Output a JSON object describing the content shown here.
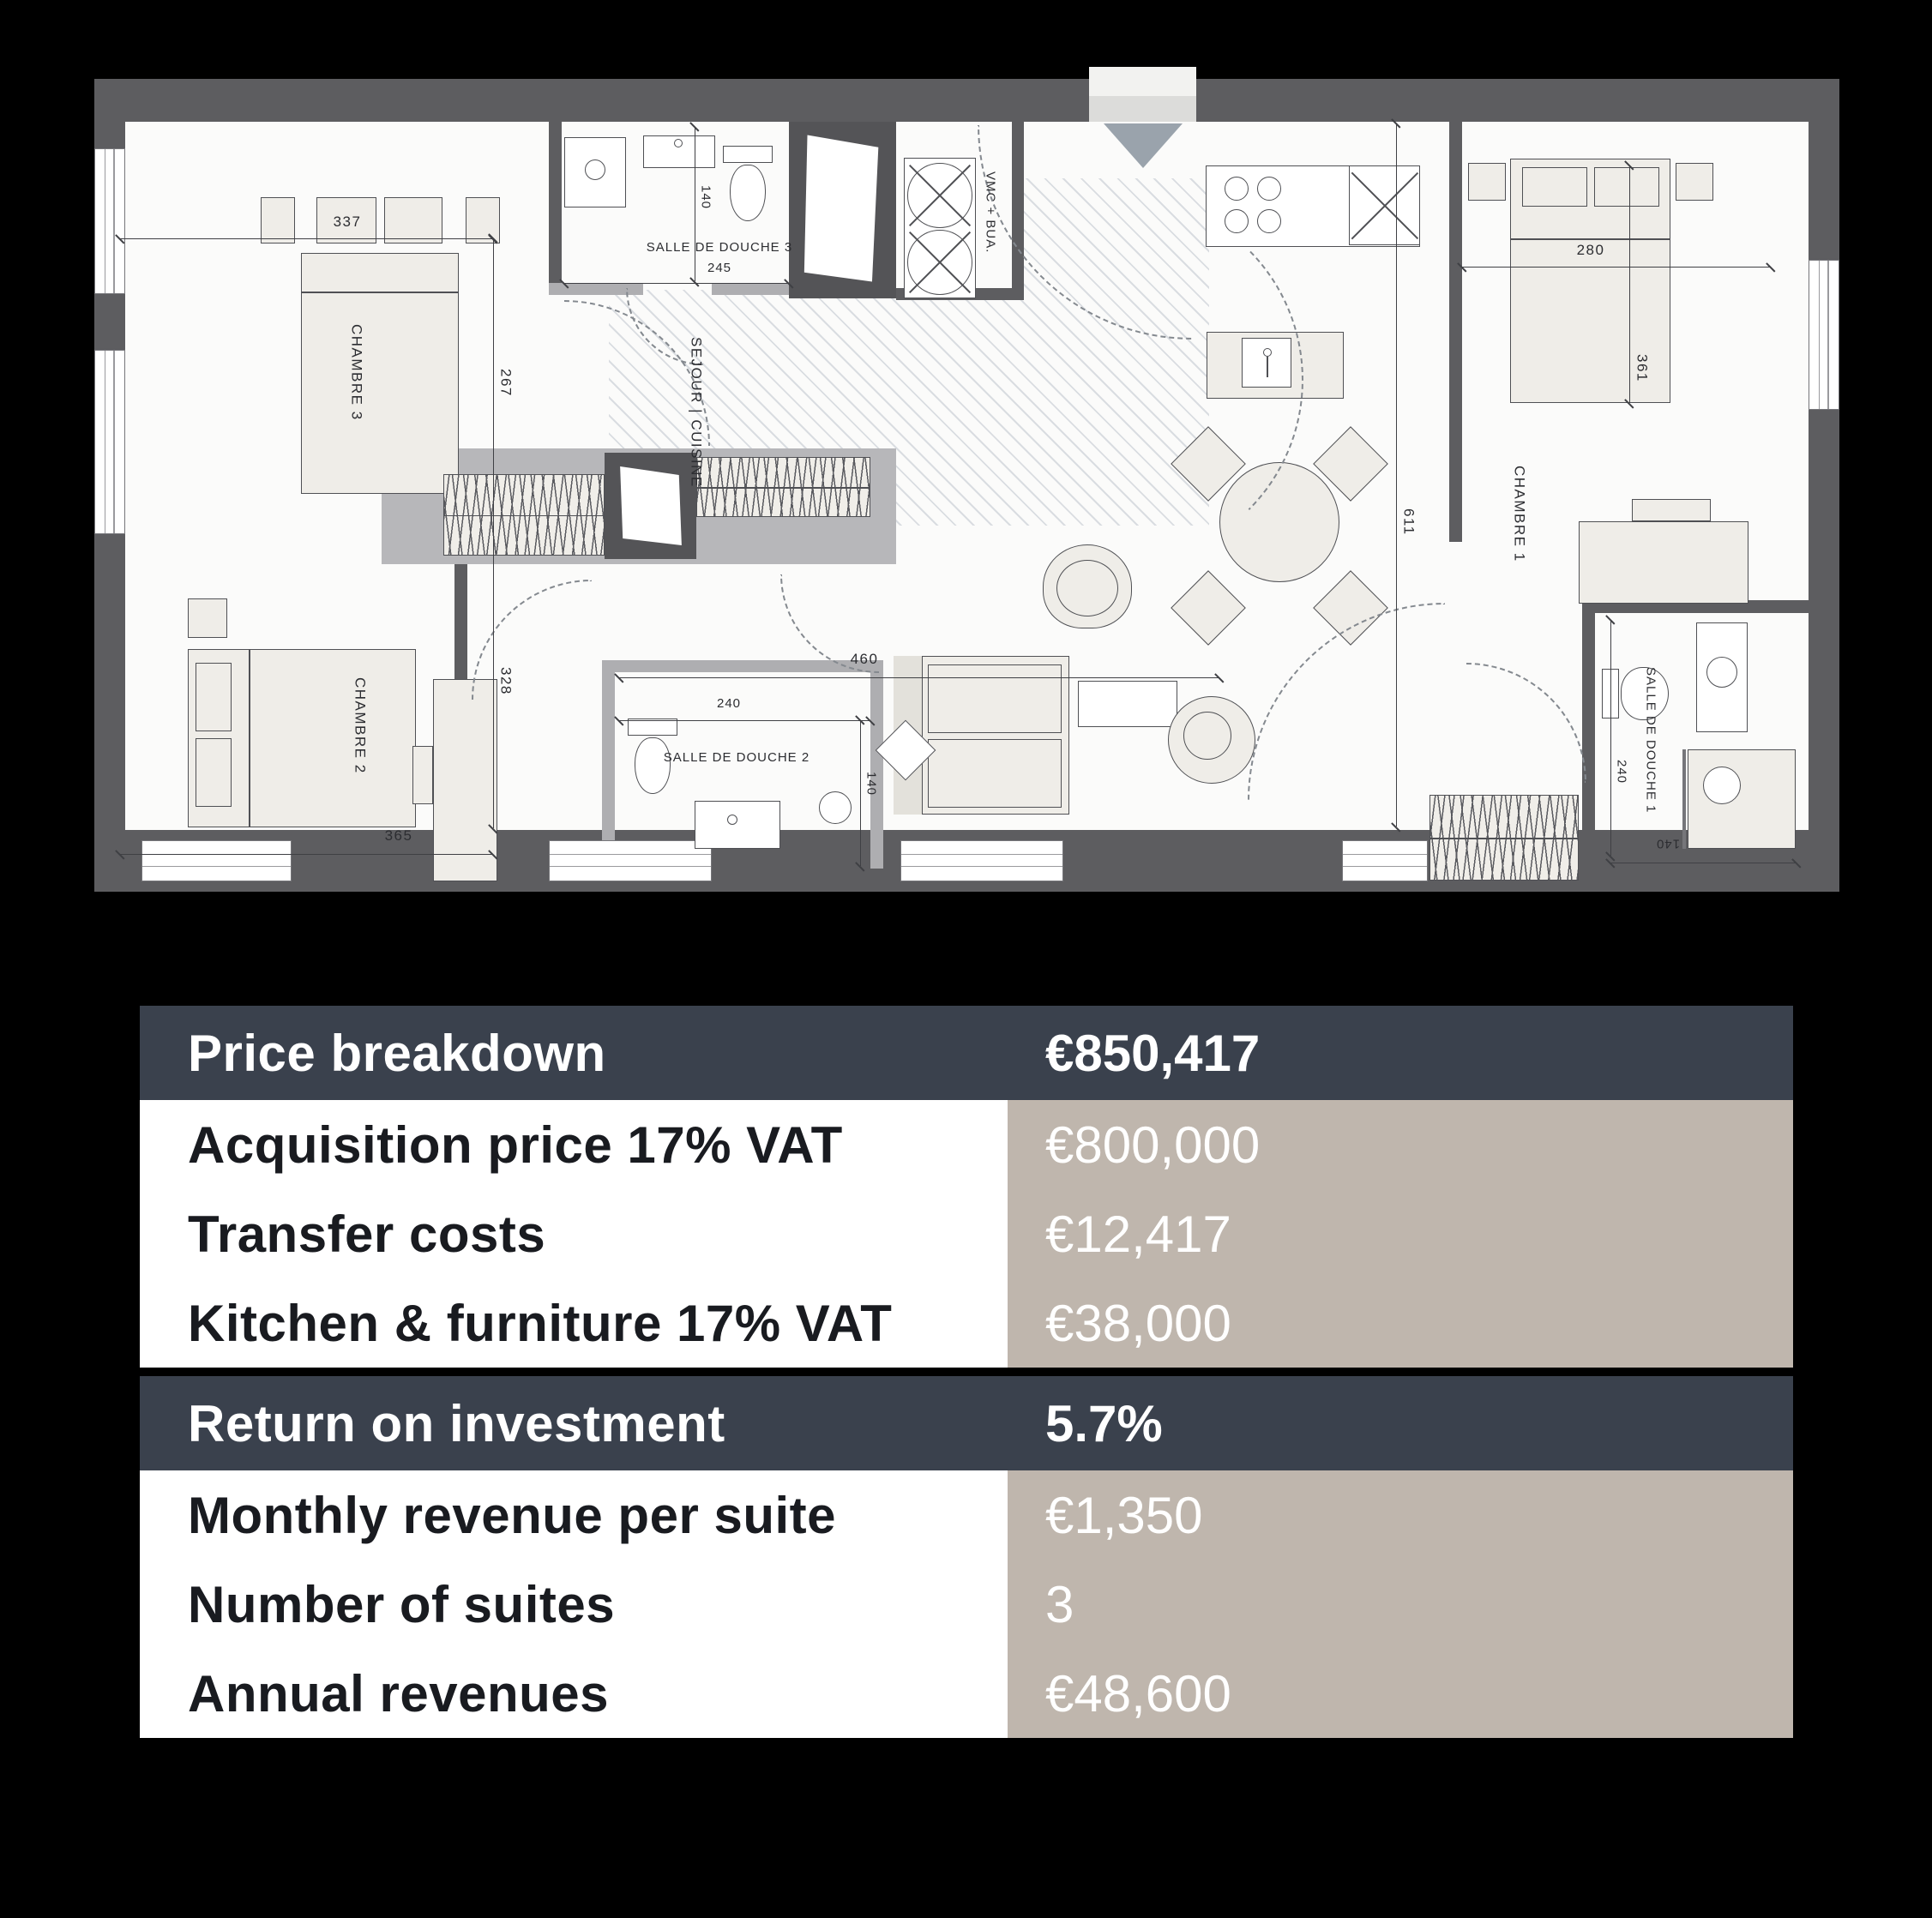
{
  "floorplan": {
    "room_labels": {
      "chambre1": "CHAMBRE 1",
      "chambre2": "CHAMBRE 2",
      "chambre3": "CHAMBRE 3",
      "salle_de_douche_1": "SALLE DE DOUCHE 1",
      "salle_de_douche_2": "SALLE DE DOUCHE 2",
      "salle_de_douche_3": "SALLE DE DOUCHE 3",
      "sejour_cuisine": "SEJOUR | CUISINE",
      "vmc_bua": "VMC + BUA."
    },
    "dimensions": {
      "chambre3_width": "337",
      "chambre3_height": "267",
      "chambre2_height": "328",
      "chambre2_width": "365",
      "sdd3_width": "245",
      "sdd3_depth": "140",
      "sdd2_width": "240",
      "sdd2_depth": "140",
      "chambre1_width": "280",
      "chambre1_height": "361",
      "sejour_height": "611",
      "sejour_width": "460",
      "sdd1_width": "240",
      "sdd1_depth": "140"
    }
  },
  "table": {
    "colors": {
      "header_bg": "#3a414d",
      "header_text": "#ffffff",
      "label_bg": "#ffffff",
      "label_text": "#191b20",
      "value_bg": "#bfb6ad",
      "value_text": "#ffffff"
    },
    "sections": [
      {
        "header": {
          "label": "Price breakdown",
          "value": "€850,417"
        },
        "rows": [
          {
            "label": "Acquisition price 17% VAT",
            "value": "€800,000"
          },
          {
            "label": "Transfer costs",
            "value": "€12,417"
          },
          {
            "label": "Kitchen & furniture 17% VAT",
            "value": "€38,000"
          }
        ]
      },
      {
        "header": {
          "label": "Return on investment",
          "value": "5.7%"
        },
        "rows": [
          {
            "label": "Monthly revenue per suite",
            "value": "€1,350"
          },
          {
            "label": "Number of suites",
            "value": "3"
          },
          {
            "label": "Annual revenues",
            "value": "€48,600"
          }
        ]
      }
    ]
  }
}
